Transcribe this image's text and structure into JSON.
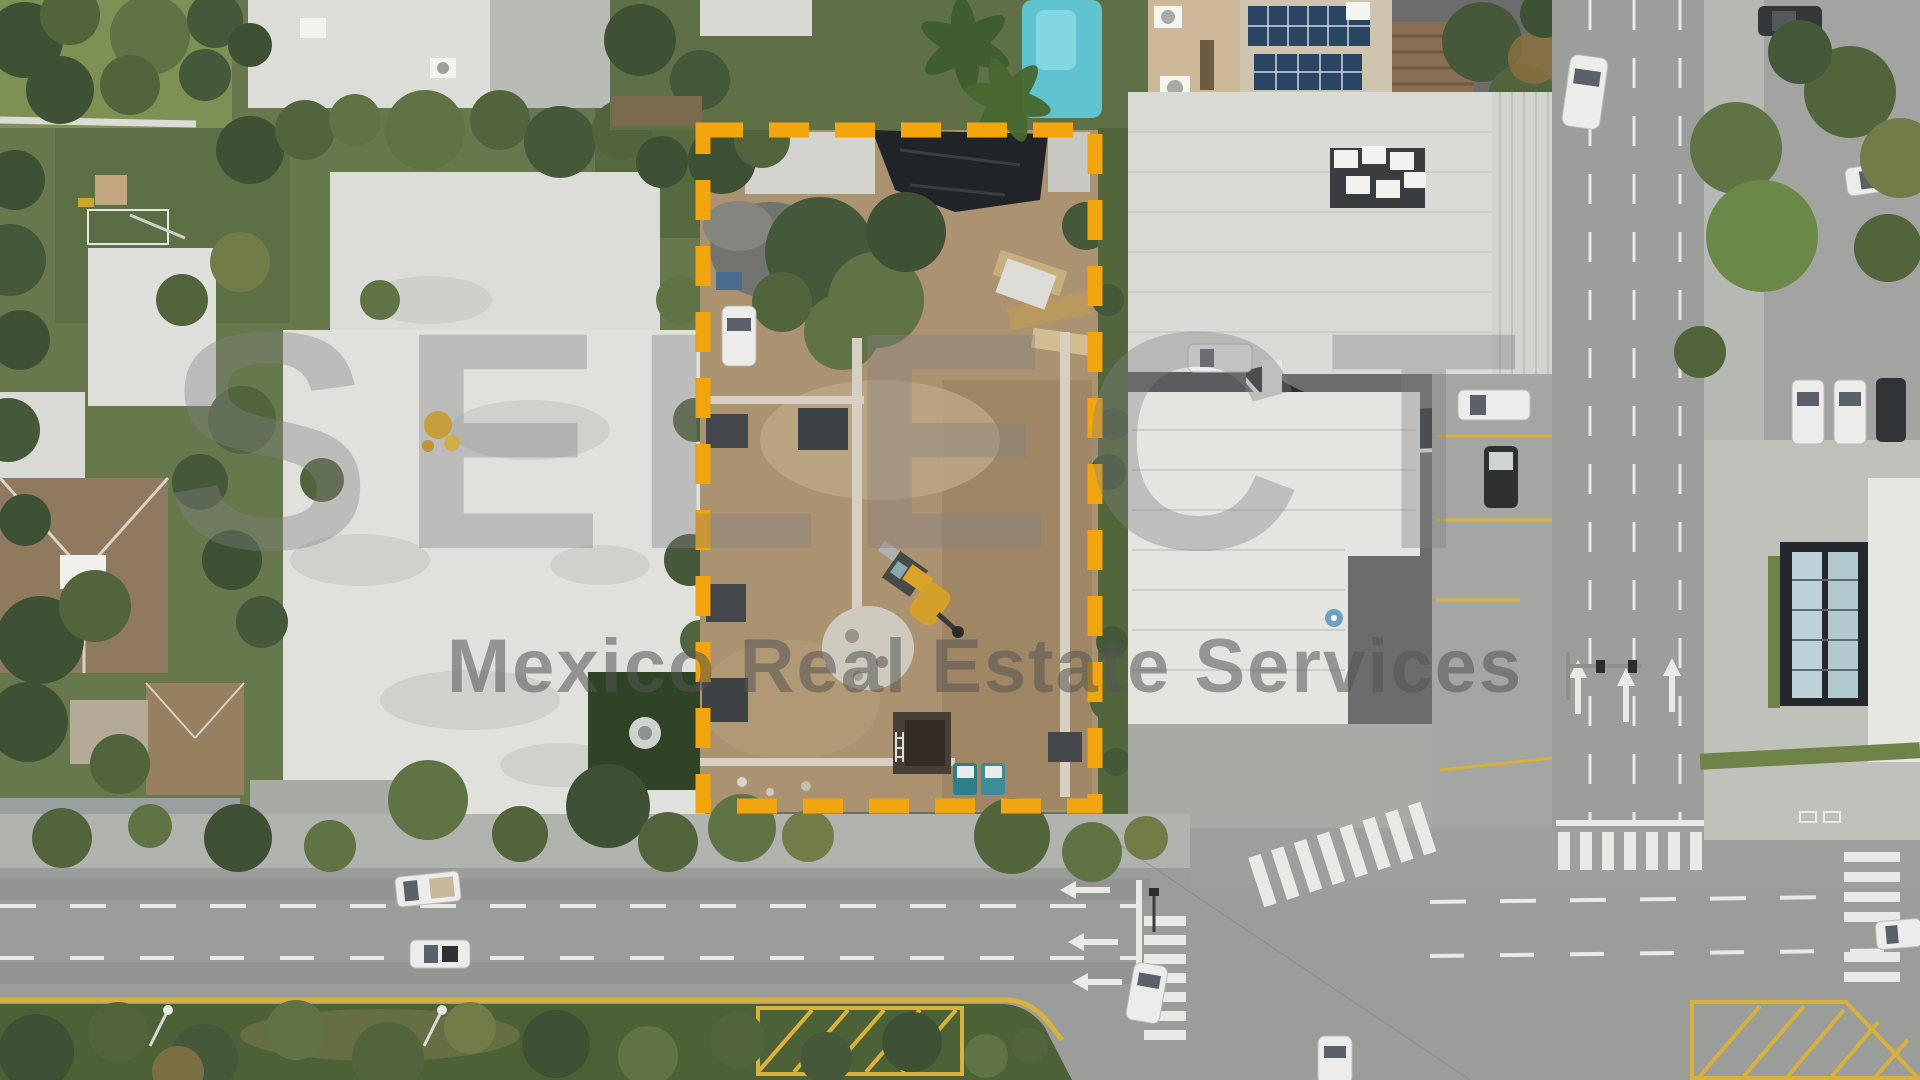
{
  "watermark": {
    "logo_text": "SELECT",
    "tagline": "Mexico Real Estate Services"
  },
  "colors": {
    "lot_outline_orange": "#F2A50C",
    "lot_outline_shadow": "#1F1F1F",
    "watermark_logo_gray": "rgba(128,128,128,0.38)",
    "watermark_tagline_gray": "rgba(84,84,84,0.55)",
    "gold_emblem": "#C9971C",
    "pool_teal": "#5FC4CF",
    "solar_panel_blue": "#2A4563",
    "excavator_yellow": "#D9A429",
    "curb_yellow": "#D9B13C",
    "dirt_tan": "#AB9271",
    "roof_white": "#E0E1DD",
    "tile_roof_brown": "#8F7A60",
    "road_gray": "#9B9D9B",
    "sidewalk_gray": "#B1B3AE",
    "grass_green": "#5D7045"
  }
}
